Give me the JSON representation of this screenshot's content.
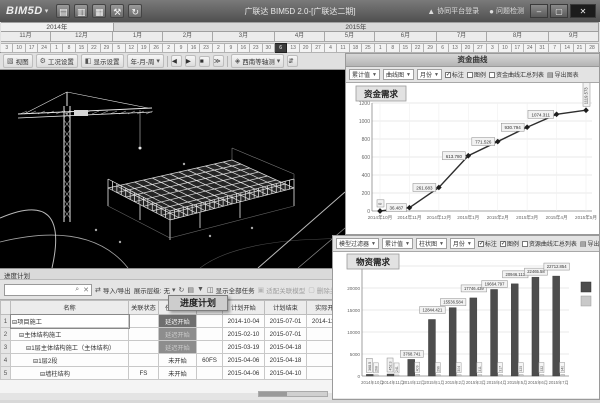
{
  "titlebar": {
    "logo": "BIM5D",
    "title": "广联达 BIM5D 2.0-[广联达二期]",
    "login_label": "协同平台登录",
    "check_label": "问题检测",
    "minimize": "–",
    "maximize": "▢",
    "close": "✕"
  },
  "timeline": {
    "years": [
      {
        "label": "2014年",
        "span": 9
      },
      {
        "label": "2015年",
        "span": 39
      }
    ],
    "months": [
      {
        "label": "11月",
        "span": 4
      },
      {
        "label": "12月",
        "span": 5
      },
      {
        "label": "1月",
        "span": 4
      },
      {
        "label": "2月",
        "span": 4
      },
      {
        "label": "3月",
        "span": 5
      },
      {
        "label": "4月",
        "span": 4
      },
      {
        "label": "5月",
        "span": 4
      },
      {
        "label": "6月",
        "span": 5
      },
      {
        "label": "7月",
        "span": 4
      },
      {
        "label": "8月",
        "span": 5
      },
      {
        "label": "9月",
        "span": 4
      }
    ],
    "days": {
      "values": [
        3,
        10,
        17,
        24,
        1,
        8,
        15,
        22,
        29,
        5,
        12,
        19,
        26,
        2,
        9,
        16,
        23,
        2,
        9,
        16,
        23,
        30,
        6,
        13,
        20,
        27,
        4,
        11,
        18,
        25,
        1,
        8,
        15,
        22,
        29,
        6,
        13,
        20,
        27,
        3,
        10,
        17,
        24,
        31,
        7,
        14,
        21,
        28
      ],
      "selected_index": 22
    }
  },
  "viewport_toolbar": {
    "view": "视图",
    "condition": "工况设置",
    "display": "显示设置",
    "time_scale": "年-月-周",
    "camera": "西南等轴测"
  },
  "funds_panel": {
    "header": "资金曲线",
    "toolbar": {
      "agg": "累计值",
      "chart_type": "曲线图",
      "period": "月份",
      "mark": "标注",
      "legend": "图例",
      "summary": "资金曲线汇总列表",
      "export": "导出图表"
    }
  },
  "materials_panel": {
    "toolbar": {
      "filter": "模型过滤器",
      "agg": "累计值",
      "chart_type": "柱状图",
      "period": "月份",
      "mark": "标注",
      "legend": "图例",
      "summary": "资源曲线汇总列表",
      "export": "导出图表"
    }
  },
  "chart_data": [
    {
      "type": "line",
      "title": "资金需求",
      "categories": [
        "2014年10月",
        "2014年11月",
        "2014年12月",
        "2015年1月",
        "2015年2月",
        "2015年3月",
        "2015年4月",
        "2015年5月"
      ],
      "values": [
        0,
        36.487,
        261.683,
        613.78,
        771.526,
        930.794,
        1074.311,
        1119.573
      ],
      "point_labels": [
        "0",
        "36.487",
        "261.683",
        "613.780",
        "771.526",
        "930.794",
        "1074.311",
        "1119.573"
      ],
      "vertical_label_indexes": [
        0,
        7
      ],
      "ylim": [
        0,
        1200
      ],
      "ytick_step": 200,
      "grid": true,
      "legend_position": "none"
    },
    {
      "type": "bar",
      "title": "物资需求",
      "categories": [
        "2014年10月",
        "2014年11月",
        "2014年12月",
        "2015年1月",
        "2015年2月",
        "2015年3月",
        "2015年4月",
        "2015年5月",
        "2015年6月",
        "2015年7月"
      ],
      "series": [
        {
          "key": "dark",
          "color": "#4d4d4d",
          "values": [
            368.5,
            452.3,
            3768.741,
            12844.421,
            15536.584,
            17746.439,
            19664.797,
            20946.113,
            22465.58,
            22712.854
          ]
        },
        {
          "key": "light",
          "color": "#c9c9c9",
          "values": [
            268,
            241,
            409,
            296,
            304,
            311,
            317,
            325,
            332,
            340
          ]
        }
      ],
      "ylim": [
        0,
        25000
      ],
      "ytick_step": 5000,
      "grid": true,
      "legend_position": "right"
    }
  ],
  "schedule_panel": {
    "header": "进度计划",
    "drag_badge": "进度计划",
    "toolbar": {
      "search_placeholder": "",
      "import": "导入/导出",
      "level_label": "展示层级:",
      "level_value": "无",
      "show_all": "显示全部任务",
      "fit_model": "适配关联模型",
      "remove": "删除关联"
    },
    "table": {
      "columns": [
        "名称",
        "关联状态",
        "任务状态",
        "前置任务",
        "计划开始",
        "计划结束",
        "实际开始"
      ],
      "rows": [
        {
          "num": "1",
          "indent": 0,
          "name": "项目施工",
          "link": "",
          "status": "延迟开始",
          "status_style": "dark1",
          "pred": "",
          "start": "2014-10-04",
          "end": "2015-07-01",
          "actual": "2014-11-04",
          "name_edit": true
        },
        {
          "num": "2",
          "indent": 1,
          "name": "主体结构施工",
          "link": "",
          "status": "延迟开始",
          "status_style": "dark2",
          "pred": "",
          "start": "2015-02-10",
          "end": "2015-07-01",
          "actual": ""
        },
        {
          "num": "3",
          "indent": 2,
          "name": "1层主体结构施工（主体结构）",
          "link": "",
          "status": "延迟开始",
          "status_style": "dark2",
          "pred": "",
          "start": "2015-03-19",
          "end": "2015-04-18",
          "actual": ""
        },
        {
          "num": "4",
          "indent": 3,
          "name": "1层2段",
          "link": "",
          "status": "未开始",
          "status_style": "",
          "pred": "60FS",
          "start": "2015-04-06",
          "end": "2015-04-18",
          "actual": ""
        },
        {
          "num": "5",
          "indent": 4,
          "name": "墙柱结构",
          "link": "FS",
          "status": "未开始",
          "status_style": "",
          "pred": "",
          "start": "2015-04-06",
          "end": "2015-04-10",
          "actual": ""
        }
      ]
    }
  }
}
